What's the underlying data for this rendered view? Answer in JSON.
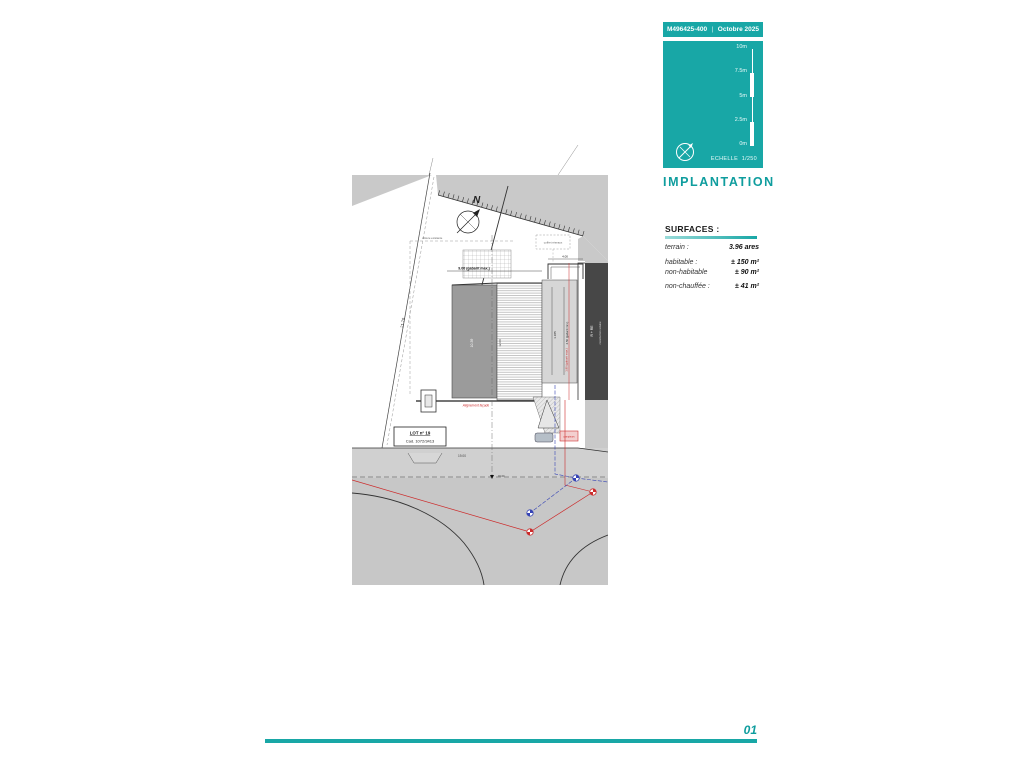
{
  "header": {
    "ref": "M496425-400",
    "separator": "|",
    "date": "Octobre 2025"
  },
  "scale_panel": {
    "tick_labels": [
      "10m",
      "7.5m",
      "5m",
      "2.5m",
      "0m"
    ],
    "echelle_label": "ECHELLE",
    "echelle_value": "1/250"
  },
  "section_title": "IMPLANTATION",
  "surfaces": {
    "heading": "SURFACES :",
    "rows": [
      {
        "label": "terrain :",
        "value": "3.96 ares"
      },
      {
        "label": "habitable :",
        "value": "± 150 m²"
      },
      {
        "label": "non-habitable",
        "value": "± 90 m²"
      },
      {
        "label": "non-chauffée :",
        "value": "± 41 m²"
      }
    ]
  },
  "plan": {
    "north_label": "N",
    "lot_label": "LOT n° 19",
    "cadastre_label": "Cad. 1072/3413",
    "dim_top": "9.00 (gabarit max.)",
    "dim_step": "4.00",
    "dim_diagonal": "23.25",
    "dim_west": "21.70",
    "dim_street": "19.00",
    "level_label": "±0.00",
    "red_facade_note": "Alignement façade",
    "red_recul_note": "1.80 (gabarit max.)",
    "dim_block_left": "10.39",
    "dim_block_mid": "12.00",
    "dim_block_r1": "1.185",
    "dim_block_r2": "2.50 (gabarit min.)",
    "note_left": "clôture existante",
    "note_right": "coffret réseaux",
    "neighbor_line1": "R + RE",
    "neighbor_line2": "construction voisine",
    "utility_box_label": "compteurs"
  },
  "footer": {
    "page_number": "01"
  },
  "colors": {
    "teal": "#18a7a6",
    "teal_text": "#0f9d9e",
    "red": "#cc2b2b",
    "blue": "#3644b5",
    "plan_gray": "#c9c9c9",
    "dark_building": "#474747"
  }
}
